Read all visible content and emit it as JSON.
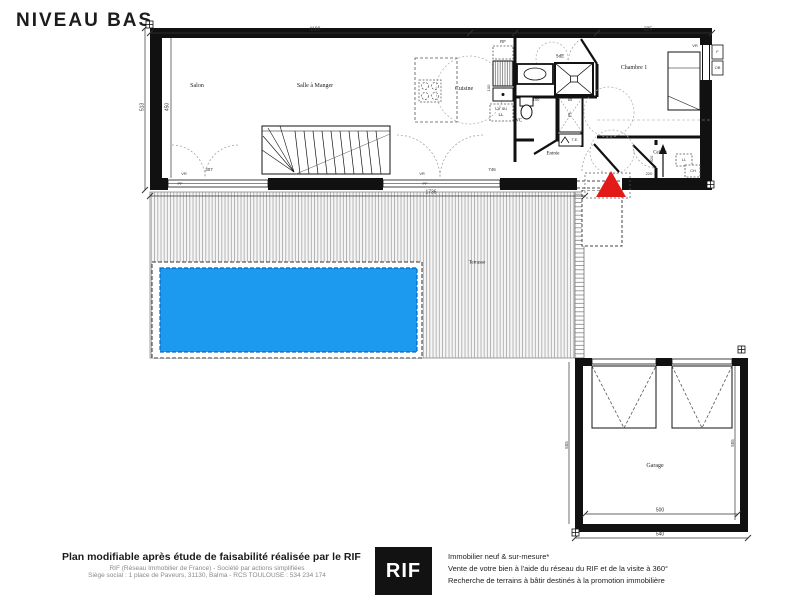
{
  "title": "NIVEAU BAS",
  "colors": {
    "pool": "#1b9af0",
    "pool_border": "#0a66c2",
    "marker": "#e31b18"
  },
  "rooms": {
    "salon": "Salon",
    "dining": "Salle à Manger",
    "kitchen": "Cuisine",
    "shower_room": "SdE",
    "bedroom": "Chambre 1",
    "wc": "WC",
    "entry": "Entrée",
    "pantry": "Cellier",
    "terrace": "Terrasse",
    "garage": "Garage"
  },
  "fixtures": {
    "fridge": "RF",
    "dishwasher": "LV ou",
    "washer": "LL",
    "closet": "PL",
    "electrical_panel": "T.E.",
    "pantry_washer": "LL",
    "boiler": "CH",
    "shutter_1": "VR",
    "shutter_2": "VR",
    "shutter_3": "VR",
    "window_sill_1": "PF",
    "window_sill_2": "PF",
    "window_f": "F",
    "window_ob": "OB"
  },
  "dims": {
    "top_main": "1100",
    "bedroom_width": "325",
    "left_outer": "513",
    "left_inner": "450",
    "salon_door": "307",
    "bay_door": "746",
    "building_total": "1736",
    "kitchen_depth": "100",
    "wc_width": "100",
    "closet_width": "65",
    "pantry_depth": "320",
    "pantry_width": "220",
    "garage_inner": "500",
    "garage_outer": "540",
    "garage_side_left": "555",
    "garage_side_right": "555"
  },
  "footer": {
    "headline": "Plan modifiable après étude de faisabilité réalisée par le RIF",
    "legal_1": "RIF (Réseau Immobilier de France)  -  Société par actions simplifiées",
    "legal_2": "Siège social : 1 place de Paveurs, 31130, Balma  -  RCS TOULOUSE : 534 234 174",
    "logo": "RIF",
    "tagline_1": "Immobilier neuf & sur-mesure*",
    "tagline_2": "Vente de votre bien à l'aide du réseau du RIF et de la visite à 360°",
    "tagline_3": "Recherche de terrains à bâtir destinés à la promotion immobilière"
  }
}
